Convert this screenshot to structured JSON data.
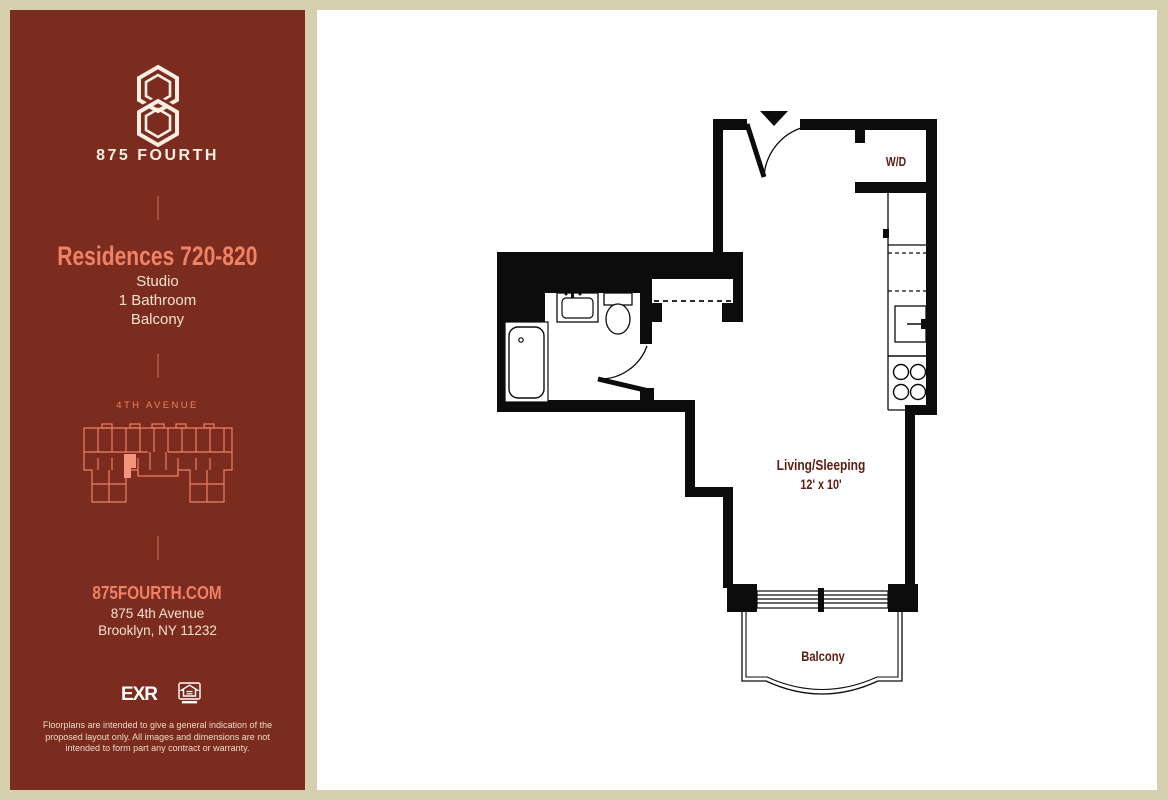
{
  "sidebar": {
    "brand": {
      "wordmark": "875 FOURTH"
    },
    "residence": {
      "title": "Residences 720-820",
      "specs": [
        "Studio",
        "1 Bathroom",
        "Balcony"
      ]
    },
    "keyplan": {
      "street_label": "4TH AVENUE"
    },
    "contact": {
      "website": "875FOURTH.COM",
      "address_line1": "875 4th Avenue",
      "address_line2": "Brooklyn, NY 11232"
    },
    "logos": {
      "brokerage": "EXR"
    },
    "disclaimer": "Floorplans are intended to give a general indication of the proposed layout only. All images and dimensions are not intended to form part any contract or warranty."
  },
  "floorplan": {
    "labels": {
      "washer_dryer": "W/D",
      "living": "Living/Sleeping",
      "living_dims": "12' x 10'",
      "balcony": "Balcony"
    }
  },
  "colors": {
    "sidebar_background": "#7b2c1e",
    "accent_salmon": "#ef8165",
    "cream_text": "#f2e2cf",
    "frame_beige": "#d6d0ae",
    "plan_walls": "#0c0c0c",
    "plan_label_red": "#5e1b10"
  }
}
